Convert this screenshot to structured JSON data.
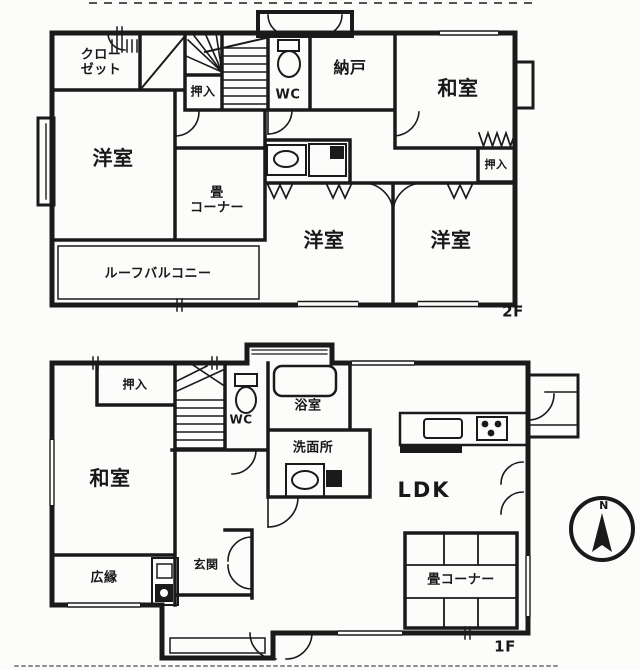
{
  "document": {
    "type": "floor-plan-scan",
    "floors_shown": "2F / 1F"
  },
  "floor_2f": {
    "floor_label": "2F",
    "rooms": {
      "closet": "クロー\nゼット",
      "oshiire_top": "押入",
      "wc": "WC",
      "nando": "納戸",
      "washitsu": "和室",
      "oshiire_side": "押入",
      "yoshitsu_left": "洋室",
      "tatami_corner": "畳\nコーナー",
      "yoshitsu_center": "洋室",
      "yoshitsu_right": "洋室",
      "roof_balcony": "ルーフバルコニー"
    }
  },
  "floor_1f": {
    "floor_label": "1F",
    "rooms": {
      "oshiire": "押入",
      "wc": "WC",
      "bath": "浴室",
      "senmenjo": "洗面所",
      "washitsu": "和室",
      "ldk": "LDK",
      "hiroen": "広縁",
      "genkan": "玄関",
      "tatami_corner": "畳コーナー"
    }
  },
  "compass": {
    "north_label": "N"
  },
  "colors": {
    "ink": "#1a1a1a",
    "paper": "#fcfcfb"
  }
}
